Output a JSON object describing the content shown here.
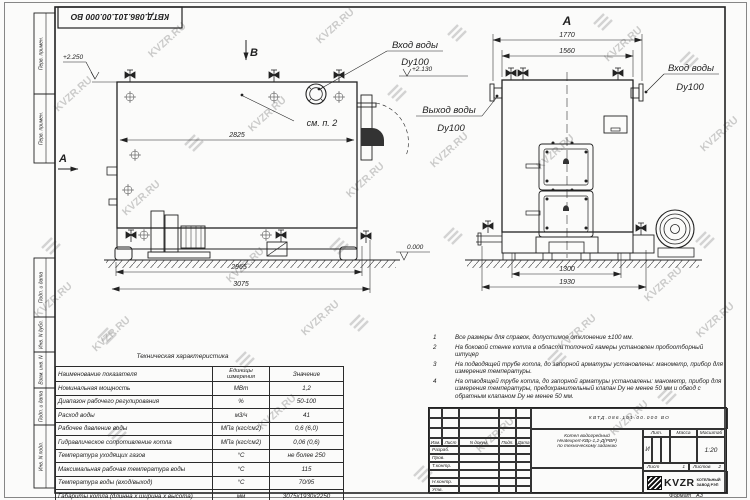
{
  "watermark": {
    "text": "KVZR.RU"
  },
  "corner_stamp": {
    "designation": "КВТД.086.101.00.000 ВО"
  },
  "margins": {
    "top1": "Перв. примен.",
    "top2": "Перв. примен.",
    "b1": "Подп. и дата",
    "b2": "Инв. N дубл.",
    "b3": "Взам. инв. N",
    "b4": "Подп. и дата",
    "b5": "Инв. N подл."
  },
  "drawing": {
    "view_b_label": "В",
    "section_a_label": "А",
    "view_a_label": "А",
    "elev_top": "+2.250",
    "elev_mid": "+2.130",
    "elev_zero": "0.000",
    "see_note": "см. п. 2",
    "inlet_label": "Вход воды",
    "inlet_dn": "Dy100",
    "outlet_label": "Выход воды",
    "outlet_dn": "Dy100",
    "inlet2_label": "Вход воды",
    "inlet2_dn": "Dy100",
    "dims": {
      "d2825": "2825",
      "d2965": "2965",
      "d3075": "3075",
      "d1770": "1770",
      "d1560": "1560",
      "d1300": "1300",
      "d1930": "1930"
    }
  },
  "notes": {
    "items": [
      {
        "num": "1",
        "text": "Все размеры для справок, допустимое отклонение ±100 мм."
      },
      {
        "num": "2",
        "text": "На боковой стенке котла в области топочной камеры установлен пробоотборный штуцер"
      },
      {
        "num": "3",
        "text": "На подводящей трубе котла, до запорной арматуры установлены: манометр, прибор для измерения температуры."
      },
      {
        "num": "4",
        "text": "На отводящей трубе котла, до запорной арматуры установлены: манометр, прибор для измерения температуры, предохранительный клапан Dу не менее 50 мм и обвод с обратным клапаном Dу не менее 50 мм."
      }
    ]
  },
  "tech_table": {
    "title": "Техническая характеристика",
    "col_name": "Наименование показателя",
    "col_units": "Единицы измерения",
    "col_value": "Значение",
    "rows": [
      {
        "name": "Номинальная мощность",
        "units": "МВт",
        "value": "1,2"
      },
      {
        "name": "Диапазон рабочего регулирования",
        "units": "%",
        "value": "50-100"
      },
      {
        "name": "Расход воды",
        "units": "м3/ч",
        "value": "41"
      },
      {
        "name": "Рабочее давление воды",
        "units": "МПа (кгс/см2)",
        "value": "0,6 (6,0)"
      },
      {
        "name": "Гидравлическое сопротивление котла",
        "units": "МПа (кгс/см2)",
        "value": "0,06 (0,6)"
      },
      {
        "name": "Температура уходящих газов",
        "units": "°С",
        "value": "не более 250"
      },
      {
        "name": "Максимальная рабочая температура воды",
        "units": "°С",
        "value": "115"
      },
      {
        "name": "Температура воды (вход/выход)",
        "units": "°С",
        "value": "70/95"
      },
      {
        "name": "Габариты котла (длинна х ширина х высота)",
        "units": "мм",
        "value": "3075х1930х2250"
      }
    ]
  },
  "title_block": {
    "designation": "КВТД.086.101.00.000  ВО",
    "name1": "Котел водогрейный",
    "name2": "Heatexpert-КВр-1,2-Д(РВР)",
    "name3": "по техническому заданию",
    "h_izm": "Изм.",
    "h_list": "Лист",
    "h_doc": "N докум.",
    "h_podp": "Подп.",
    "h_data": "Дата",
    "r1": "Разраб.",
    "r2": "Пров.",
    "r3": "Т.контр.",
    "r4": "Н.контр.",
    "r5": "Утв.",
    "lit": "Лит.",
    "lit_val": "И",
    "mass": "Масса",
    "scale": "Масштаб",
    "scale_val": "1:20",
    "sheet": "Лист",
    "sheet_val": "1",
    "sheets": "Листов",
    "sheets_val": "2",
    "brand": "KVZR",
    "brand_line1": "КОТЕЛЬНЫЙ",
    "brand_line2": "ЗАВОД РЭП",
    "format_label": "Формат",
    "format_val": "А3"
  }
}
